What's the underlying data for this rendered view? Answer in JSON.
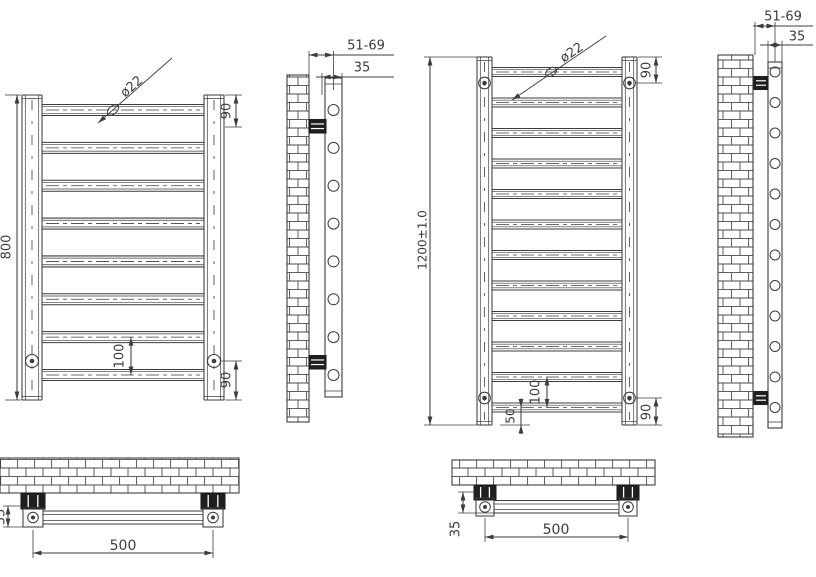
{
  "page": {
    "background": "#ffffff"
  },
  "drawing": {
    "line_color": "#3c3c3c",
    "brick_color": "#4a4a4a",
    "bracket_fill": "#1f1f1f",
    "radiator_small": {
      "front": {
        "rung_count": 8,
        "height_label": "800",
        "diameter_label": "ø22",
        "top_offset_label": "90",
        "bottom_offset_label": "90",
        "rung_gap_label": "100"
      },
      "side": {
        "wall_distance_label": "51-69",
        "depth_label": "35"
      },
      "bottom": {
        "width_label": "500",
        "wall_gap_label": "35"
      }
    },
    "radiator_large": {
      "front": {
        "rung_count": 12,
        "height_label": "1200±1.0",
        "diameter_label": "ø22",
        "top_offset_label": "90",
        "bottom_offset_label": "90",
        "rung_gap_label": "100",
        "end_gap_label": "50"
      },
      "side": {
        "wall_distance_label": "51-69",
        "depth_label": "35"
      },
      "bottom": {
        "width_label": "500",
        "wall_gap_label": "35"
      }
    }
  }
}
